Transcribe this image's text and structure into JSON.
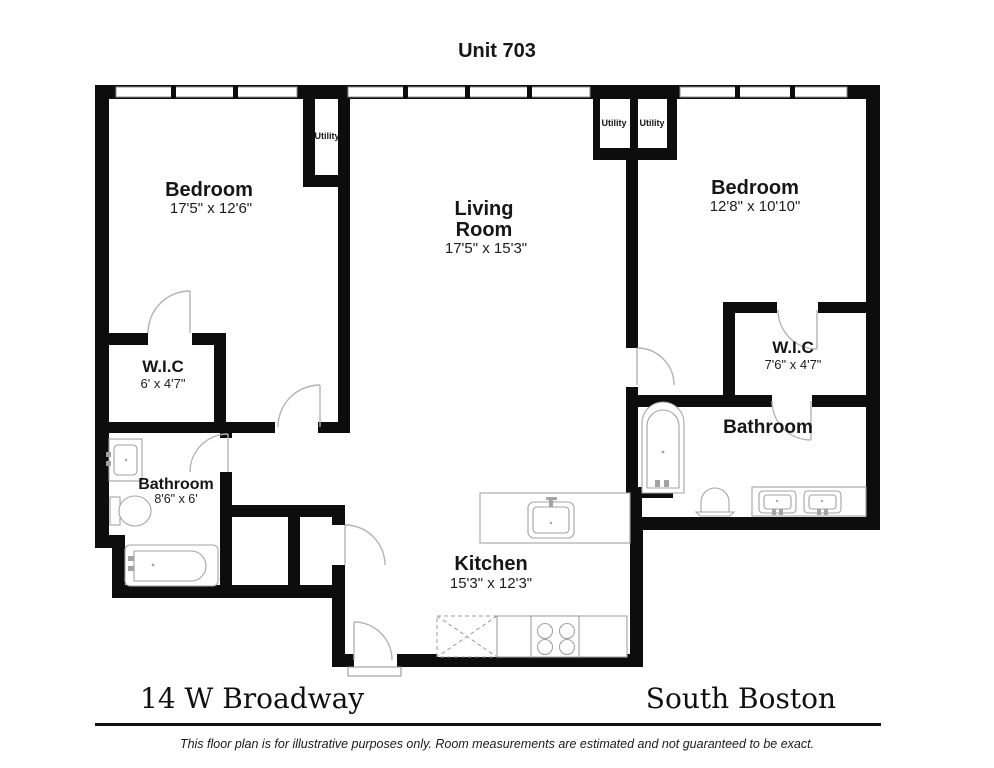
{
  "title": "Unit 703",
  "rooms": {
    "bedroom_left": {
      "label": "Bedroom",
      "dims": "17'5\" x 12'6\""
    },
    "living_room": {
      "line1": "Living",
      "line2": "Room",
      "dims": "17'5\" x 15'3\""
    },
    "bedroom_right": {
      "label": "Bedroom",
      "dims": "12'8\" x 10'10\""
    },
    "wic_left": {
      "label": "W.I.C",
      "dims": "6' x 4'7\""
    },
    "wic_right": {
      "label": "W.I.C",
      "dims": "7'6\" x 4'7\""
    },
    "bathroom_left": {
      "label": "Bathroom",
      "dims": "8'6\" x 6'"
    },
    "bathroom_right": {
      "label": "Bathroom"
    },
    "kitchen": {
      "label": "Kitchen",
      "dims": "15'3\" x 12'3\""
    },
    "utility_left": {
      "label": "Utility"
    },
    "utility_right_a": {
      "label": "Utility"
    },
    "utility_right_b": {
      "label": "Utility"
    }
  },
  "footer": {
    "address": "14 W Broadway",
    "neighborhood": "South Boston",
    "disclaimer": "This floor plan is for illustrative purposes only. Room measurements are estimated and not guaranteed to be exact."
  },
  "colors": {
    "wall": "#0d0d0d",
    "fixture_outline": "#a3a3a3",
    "door_arc": "#b3b3b3"
  }
}
